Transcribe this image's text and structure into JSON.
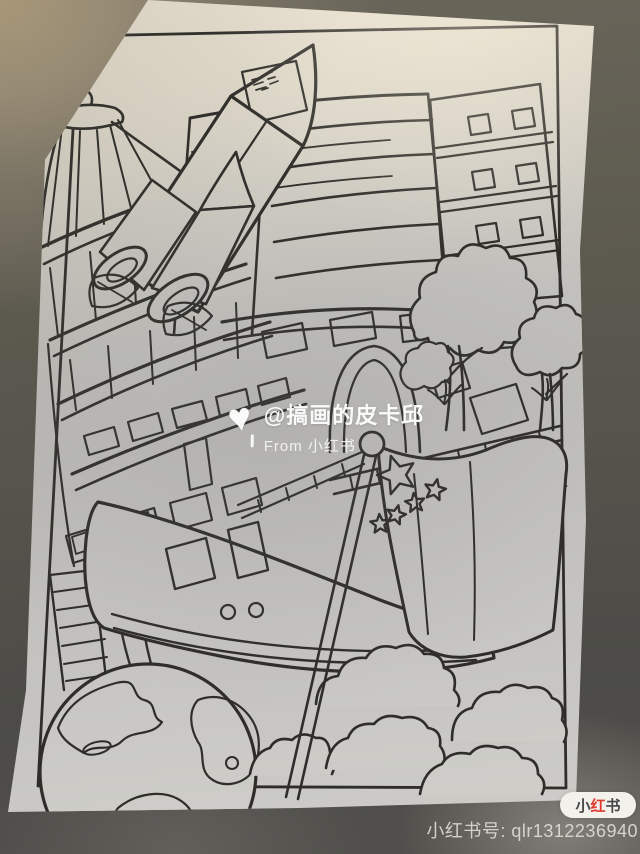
{
  "watermark": {
    "heart_icon": "♥",
    "handle": "@搞画的皮卡邱",
    "source": "From 小红书"
  },
  "badge": {
    "char_1": "小",
    "char_2": "红",
    "char_3": "书"
  },
  "footer": {
    "account_id": "小红书号: qlr1312236940"
  },
  "colors": {
    "ink": "#2e2d29",
    "badge_accent": "#e0392e",
    "badge_background": "#f3f1ec",
    "watermark_text": "#ffffff",
    "table": "#a89878",
    "floor": "#4c4b47"
  },
  "drawing_elements": [
    "border-frame",
    "pagoda-tower",
    "window-tiers",
    "office-building",
    "apartment-building",
    "arch-building",
    "railway-track",
    "bridge-railing",
    "trees",
    "rocket",
    "high-speed-train",
    "ladder",
    "earth-globe",
    "clouds",
    "china-flag",
    "flag-stars"
  ]
}
